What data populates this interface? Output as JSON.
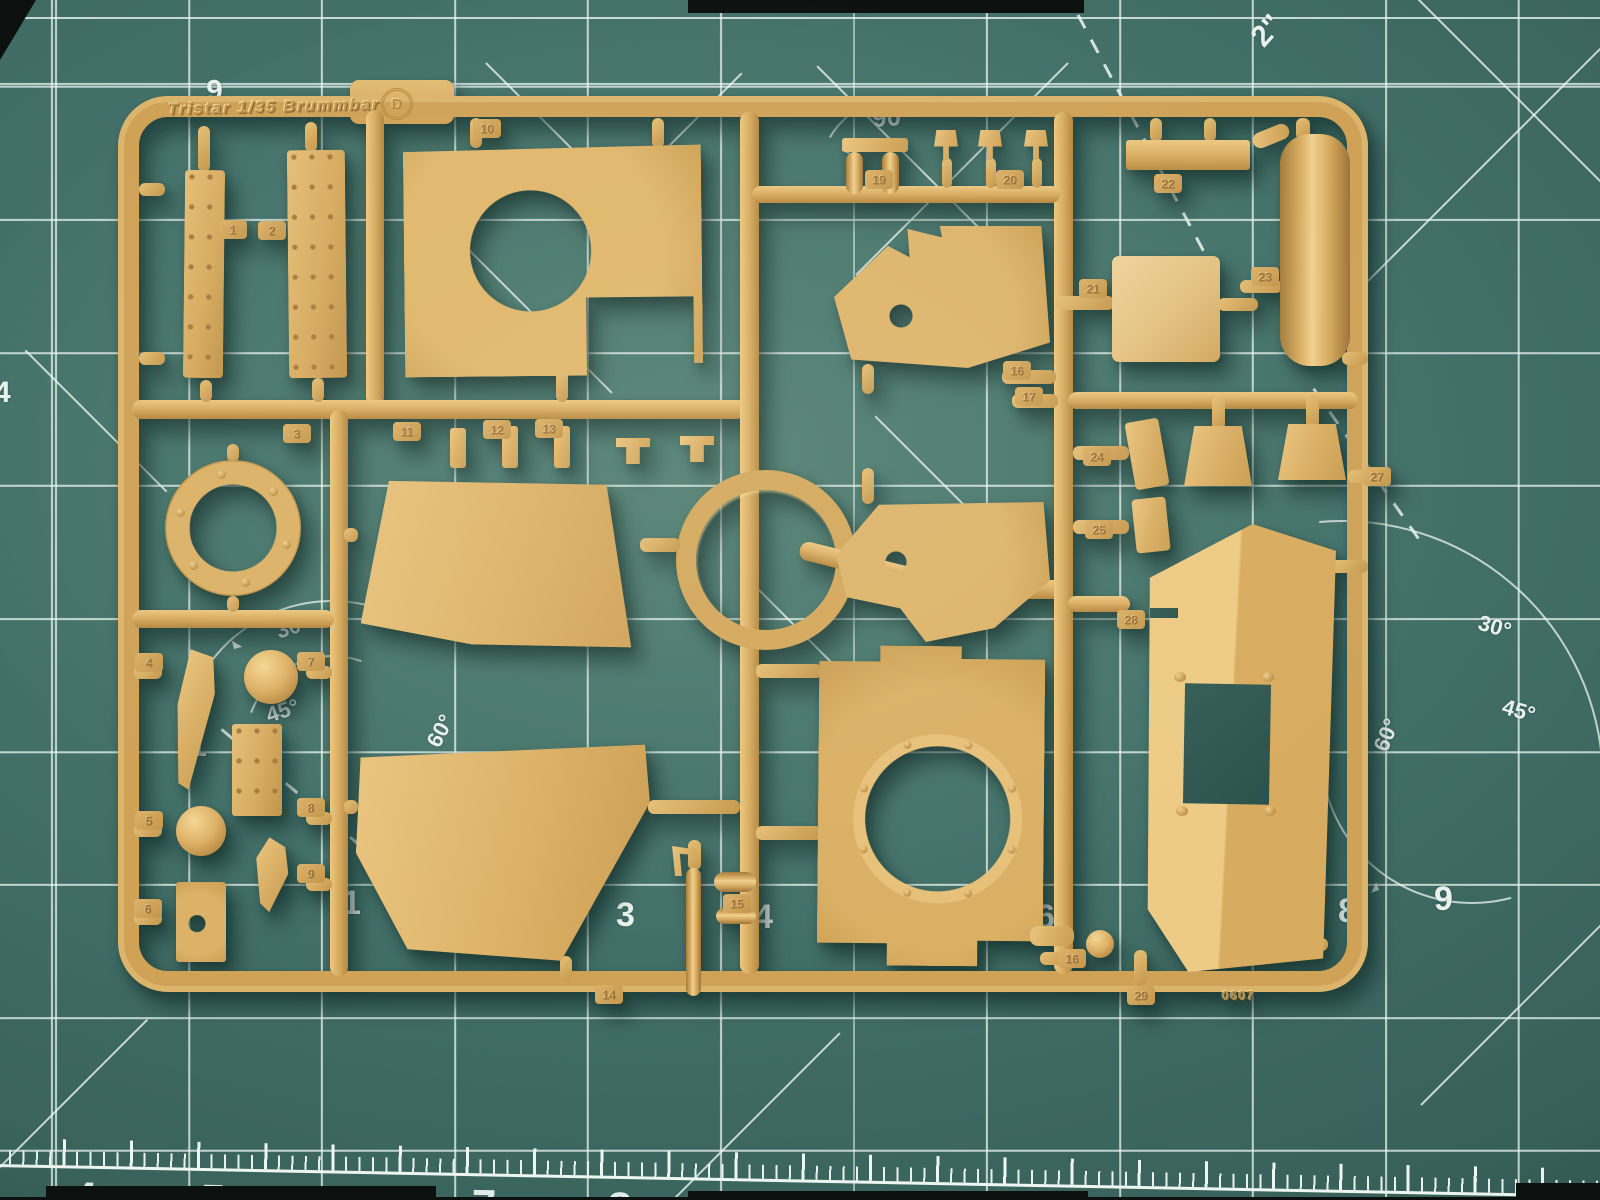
{
  "scene": {
    "description": "Tan injection-molded plastic model sprue (letter D) from a Tristar 1/35 Brummbar kit, lying on a green self-healing cutting mat with white grid, angle and ruler markings",
    "colors": {
      "mat_base": "#437169",
      "mat_shadowed": "#2a4e49",
      "grid_line": "#e9f4ef",
      "plastic_base": "#dcb168",
      "plastic_highlight": "#f1d08f",
      "plastic_shadow": "#a47b3c",
      "cast_shadow": "rgba(10,34,30,0.45)"
    }
  },
  "sprue": {
    "brand_text": "Tristar 1/35 Brummbar",
    "sprue_letter": "D",
    "mold_code": "0607",
    "part_tags": [
      {
        "num": "1",
        "x": 233,
        "y": 230
      },
      {
        "num": "2",
        "x": 272,
        "y": 231
      },
      {
        "num": "10",
        "x": 487,
        "y": 129
      },
      {
        "num": "3",
        "x": 297,
        "y": 434
      },
      {
        "num": "11",
        "x": 407,
        "y": 432
      },
      {
        "num": "12",
        "x": 497,
        "y": 430
      },
      {
        "num": "13",
        "x": 549,
        "y": 429
      },
      {
        "num": "4",
        "x": 149,
        "y": 663
      },
      {
        "num": "7",
        "x": 311,
        "y": 662
      },
      {
        "num": "5",
        "x": 149,
        "y": 821
      },
      {
        "num": "8",
        "x": 311,
        "y": 808
      },
      {
        "num": "9",
        "x": 311,
        "y": 874
      },
      {
        "num": "6",
        "x": 148,
        "y": 909
      },
      {
        "num": "14",
        "x": 609,
        "y": 995
      },
      {
        "num": "15",
        "x": 737,
        "y": 904
      },
      {
        "num": "19",
        "x": 879,
        "y": 180
      },
      {
        "num": "20",
        "x": 1010,
        "y": 180
      },
      {
        "num": "16",
        "x": 1017,
        "y": 371
      },
      {
        "num": "17",
        "x": 1029,
        "y": 397
      },
      {
        "num": "21",
        "x": 1093,
        "y": 289
      },
      {
        "num": "22",
        "x": 1168,
        "y": 184
      },
      {
        "num": "23",
        "x": 1265,
        "y": 277
      },
      {
        "num": "24",
        "x": 1097,
        "y": 457
      },
      {
        "num": "25",
        "x": 1099,
        "y": 530
      },
      {
        "num": "27",
        "x": 1377,
        "y": 477
      },
      {
        "num": "28",
        "x": 1131,
        "y": 620
      },
      {
        "num": "16",
        "x": 1072,
        "y": 959
      },
      {
        "num": "29",
        "x": 1141,
        "y": 996
      }
    ]
  },
  "mat": {
    "labels": [
      {
        "text": "6",
        "x": 206,
        "y": 74,
        "rot": 180,
        "size": 30
      },
      {
        "text": "2\"",
        "x": 1252,
        "y": 16,
        "rot": -48,
        "size": 30
      },
      {
        "text": "90",
        "x": 872,
        "y": 104,
        "rot": -4,
        "size": 26
      },
      {
        "text": "30°",
        "x": 276,
        "y": 616,
        "rot": -18,
        "size": 22
      },
      {
        "text": "45°",
        "x": 266,
        "y": 700,
        "rot": -18,
        "size": 22
      },
      {
        "text": "60°",
        "x": 424,
        "y": 720,
        "rot": -62,
        "size": 22
      },
      {
        "text": "30°",
        "x": 1478,
        "y": 616,
        "rot": 16,
        "size": 22
      },
      {
        "text": "45°",
        "x": 1502,
        "y": 700,
        "rot": 16,
        "size": 22
      },
      {
        "text": "60°",
        "x": 1370,
        "y": 724,
        "rot": -68,
        "size": 22
      },
      {
        "text": "1",
        "x": 188,
        "y": 728,
        "rot": 0,
        "size": 34
      },
      {
        "text": "1",
        "x": 342,
        "y": 886,
        "rot": 0,
        "size": 34
      },
      {
        "text": "3",
        "x": 616,
        "y": 898,
        "rot": 0,
        "size": 34
      },
      {
        "text": "4",
        "x": 754,
        "y": 900,
        "rot": 0,
        "size": 34
      },
      {
        "text": "6",
        "x": 1036,
        "y": 900,
        "rot": 0,
        "size": 34
      },
      {
        "text": "8",
        "x": 1338,
        "y": 894,
        "rot": 0,
        "size": 34
      },
      {
        "text": "9",
        "x": 1434,
        "y": 882,
        "rot": 0,
        "size": 34
      },
      {
        "text": "4",
        "x": -6,
        "y": 378,
        "rot": 0,
        "size": 30
      }
    ],
    "ruler_numbers": [
      {
        "text": "4",
        "x": 78
      },
      {
        "text": "5",
        "x": 206
      },
      {
        "text": "6",
        "x": 341
      },
      {
        "text": "7",
        "x": 477
      },
      {
        "text": "8",
        "x": 613
      }
    ]
  }
}
